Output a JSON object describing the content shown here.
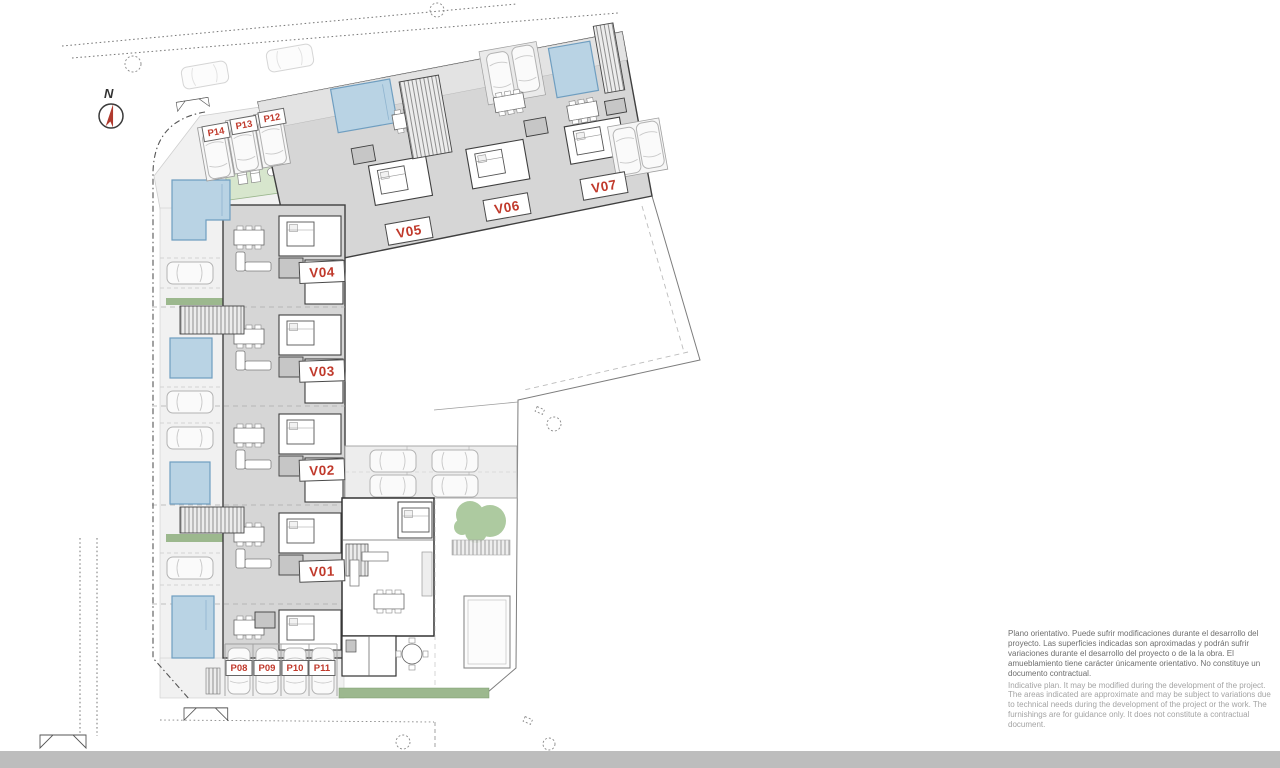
{
  "plan": {
    "north_label": "N",
    "units": {
      "v01": "V01",
      "v02": "V02",
      "v03": "V03",
      "v04": "V04",
      "v05": "V05",
      "v06": "V06",
      "v07": "V07"
    },
    "parking": {
      "p08": "P08",
      "p09": "P09",
      "p10": "P10",
      "p11": "P11",
      "p12": "P12",
      "p13": "P13",
      "p14": "P14"
    }
  },
  "disclaimer": {
    "es": "Plano orientativo. Puede sufrir modificaciones durante el desarrollo del proyecto. Las superficies indicadas son aproximadas y podrán sufrir variaciones durante el desarrollo del proyecto o de la la obra. El amueblamiento tiene carácter únicamente orientativo. No constituye un documento contractual.",
    "en": "Indicative plan. It may be modified during the development of the project. The areas indicated are approximate and may be subject to variations due to technical needs during the development of the project or the work. The furnishings are for guidance only. It does not constitute a contractual document."
  },
  "colors": {
    "accent_red": "#c0392b",
    "pool_blue": "#b9d3e4",
    "building_gray": "#d6d6d6",
    "landscape_green": "#a9c89b",
    "road_gray": "#bdbdbd"
  }
}
